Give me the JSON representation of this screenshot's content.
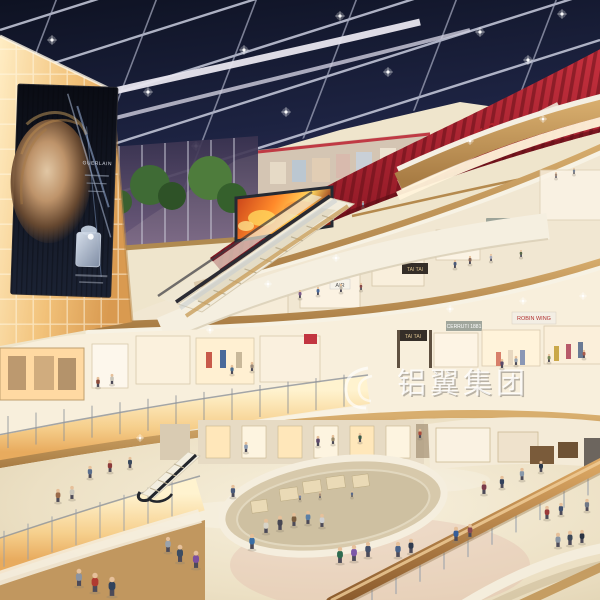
{
  "meta": {
    "title": "Shopping mall atrium interior rendering"
  },
  "signs": {
    "theatres": "THEATRES",
    "tai_tai": "TAI TAI",
    "air": "AIR",
    "cerruti": "CERRUTI 1881",
    "robin": "ROBIN WING",
    "billboard_brand": "GUERLAIN",
    "watermark": "铝翼集团"
  },
  "colors": {
    "sky_top": "#0e1222",
    "sky_horizon": "#7b5f80",
    "theatre_red": "#b3242e",
    "amber_glow": "#f2c27a",
    "wood": "#c49a58",
    "floor": "#efe5cc",
    "soffit": "#f7f2e4",
    "led_fire": "#ff8a2a",
    "glass_wall": "#564a6a",
    "watermark_white": "#ffffff"
  },
  "people": [
    [
      95,
      592,
      19,
      "#b03a30"
    ],
    [
      112,
      596,
      19,
      "#32435c"
    ],
    [
      79,
      586,
      17,
      "#8b93a0"
    ],
    [
      180,
      562,
      17,
      "#3c4d63"
    ],
    [
      196,
      568,
      17,
      "#7c4fa0"
    ],
    [
      168,
      552,
      15,
      "#9aa3ad"
    ],
    [
      252,
      549,
      15,
      "#3a6ea5"
    ],
    [
      266,
      533,
      14,
      "#d8d4c8"
    ],
    [
      280,
      530,
      14,
      "#474753"
    ],
    [
      294,
      526,
      13,
      "#7a5c3e"
    ],
    [
      308,
      524,
      13,
      "#5b7fa6"
    ],
    [
      322,
      527,
      13,
      "#cfd0d2"
    ],
    [
      340,
      563,
      16,
      "#2d6a4f"
    ],
    [
      354,
      561,
      16,
      "#7d57a8"
    ],
    [
      368,
      557,
      15,
      "#44506a"
    ],
    [
      398,
      557,
      15,
      "#48628a"
    ],
    [
      411,
      553,
      14,
      "#303a4e"
    ],
    [
      456,
      541,
      14,
      "#355e9a"
    ],
    [
      470,
      537,
      13,
      "#8a4a52"
    ],
    [
      547,
      519,
      13,
      "#9a3a3a"
    ],
    [
      561,
      515,
      12,
      "#40506e"
    ],
    [
      587,
      511,
      12,
      "#6f7886"
    ],
    [
      233,
      497,
      12,
      "#4a5a7a"
    ],
    [
      58,
      502,
      13,
      "#9a6a4a"
    ],
    [
      72,
      499,
      13,
      "#c9c5ba"
    ],
    [
      90,
      478,
      12,
      "#5a6e8c"
    ],
    [
      110,
      472,
      12,
      "#8c3a3a"
    ],
    [
      130,
      468,
      11,
      "#3a4a5e"
    ],
    [
      246,
      452,
      10,
      "#8a9ab0"
    ],
    [
      318,
      446,
      10,
      "#5e4a6a"
    ],
    [
      333,
      444,
      9,
      "#9a8a6a"
    ],
    [
      360,
      442,
      9,
      "#3a5a4a"
    ],
    [
      420,
      438,
      9,
      "#aa4a3a"
    ],
    [
      484,
      494,
      13,
      "#7a3a4a"
    ],
    [
      502,
      488,
      12,
      "#32415c"
    ],
    [
      522,
      480,
      12,
      "#8898aa"
    ],
    [
      541,
      472,
      11,
      "#2c3a4c"
    ],
    [
      558,
      547,
      14,
      "#8a96a4"
    ],
    [
      570,
      545,
      14,
      "#3c4858"
    ],
    [
      582,
      543,
      13,
      "#2a3242"
    ],
    [
      98,
      387,
      10,
      "#8a4a3a"
    ],
    [
      112,
      384,
      10,
      "#c8c4b8"
    ],
    [
      232,
      374,
      9,
      "#4a6a8a"
    ],
    [
      252,
      371,
      9,
      "#9a8a7a"
    ],
    [
      502,
      368,
      9,
      "#5a4a6a"
    ],
    [
      516,
      365,
      9,
      "#98a4b2"
    ],
    [
      549,
      362,
      8,
      "#7a8a5a"
    ],
    [
      584,
      358,
      8,
      "#aa5a4a"
    ],
    [
      300,
      298,
      8,
      "#7a5a8a"
    ],
    [
      318,
      295,
      8,
      "#4a699a"
    ],
    [
      341,
      292,
      8,
      "#c0b8a8"
    ],
    [
      361,
      290,
      7,
      "#8a4a4a"
    ],
    [
      455,
      268,
      8,
      "#4a5a7a"
    ],
    [
      470,
      264,
      8,
      "#8a6a5a"
    ],
    [
      491,
      261,
      7,
      "#a8aab8"
    ],
    [
      521,
      257,
      7,
      "#5a6a4a"
    ],
    [
      363,
      207,
      6,
      "#9aa0b0"
    ],
    [
      556,
      178,
      6,
      "#a08878"
    ],
    [
      574,
      174,
      6,
      "#788494"
    ],
    [
      300,
      500,
      6,
      "#7a86a0"
    ],
    [
      320,
      498,
      6,
      "#a89078"
    ],
    [
      352,
      497,
      6,
      "#5a6a8a"
    ]
  ],
  "sparkles": {
    "ceiling": [
      [
        52,
        40
      ],
      [
        148,
        92
      ],
      [
        244,
        50
      ],
      [
        340,
        16
      ],
      [
        286,
        112
      ],
      [
        388,
        72
      ],
      [
        480,
        32
      ],
      [
        196,
        146
      ],
      [
        528,
        60
      ],
      [
        562,
        14
      ]
    ],
    "soffit": [
      [
        336,
        258
      ],
      [
        450,
        309
      ],
      [
        523,
        301
      ],
      [
        268,
        284
      ],
      [
        470,
        141
      ],
      [
        543,
        119
      ],
      [
        583,
        296
      ],
      [
        210,
        330
      ],
      [
        140,
        438
      ]
    ]
  }
}
